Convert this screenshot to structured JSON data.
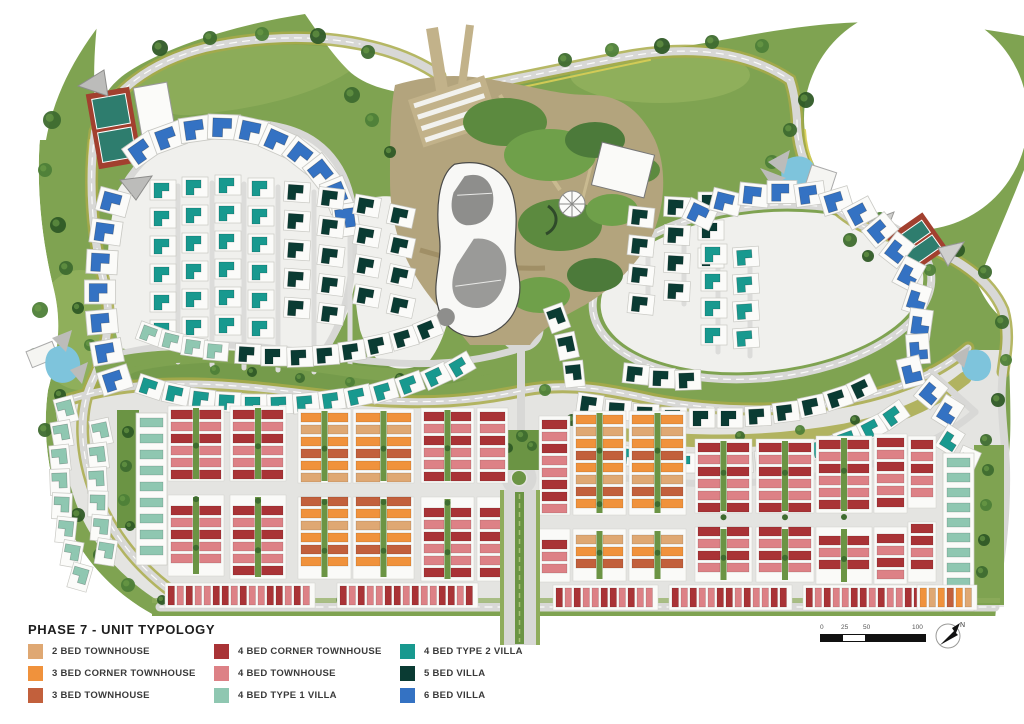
{
  "title": "PHASE 7 - UNIT TYPOLOGY",
  "colors": {
    "tan2": "#DFA873",
    "or3c": "#F0923C",
    "terra3": "#C2603C",
    "red4c": "#A93336",
    "pink4": "#DD8186",
    "mint4": "#8FC7B1",
    "teal4": "#18998F",
    "dark5": "#0A3B33",
    "blue6": "#3472C3"
  },
  "legend": {
    "columns": [
      [
        {
          "label": "2 BED TOWNHOUSE",
          "key": "tan2"
        },
        {
          "label": "3 BED CORNER TOWNHOUSE",
          "key": "or3c"
        },
        {
          "label": "3 BED TOWNHOUSE",
          "key": "terra3"
        }
      ],
      [
        {
          "label": "4 BED CORNER TOWNHOUSE",
          "key": "red4c"
        },
        {
          "label": "4 BED  TOWNHOUSE",
          "key": "pink4"
        },
        {
          "label": "4 BED  TYPE 1 VILLA",
          "key": "mint4"
        }
      ],
      [
        {
          "label": "4 BED  TYPE 2 VILLA",
          "key": "teal4"
        },
        {
          "label": "5 BED VILLA",
          "key": "dark5"
        },
        {
          "label": "6 BED VILLA",
          "key": "blue6"
        }
      ]
    ]
  },
  "scalebar": {
    "labels": [
      "0",
      "25",
      "50",
      "100"
    ]
  },
  "north": {
    "label": "N"
  },
  "map": {
    "unit_patterns": {
      "red": [
        "red4c",
        "pink4",
        "red4c",
        "pink4",
        "pink4",
        "red4c"
      ],
      "orange": [
        "or3c",
        "tan2",
        "or3c",
        "terra3",
        "or3c",
        "tan2",
        "terra3"
      ]
    },
    "villa_clusters": [
      {
        "c": "blue6",
        "s": 1.25,
        "pts": [
          [
            142,
            150,
            -35
          ],
          [
            168,
            137,
            -20
          ],
          [
            196,
            129,
            -8
          ],
          [
            224,
            127,
            2
          ],
          [
            252,
            131,
            12
          ],
          [
            278,
            141,
            24
          ],
          [
            302,
            155,
            38
          ],
          [
            322,
            173,
            52
          ],
          [
            337,
            195,
            68
          ],
          [
            346,
            220,
            82
          ]
        ]
      },
      {
        "c": "blue6",
        "s": 1.2,
        "pts": [
          [
            113,
            202,
            15
          ],
          [
            106,
            232,
            8
          ],
          [
            102,
            262,
            3
          ],
          [
            100,
            292,
            0
          ],
          [
            102,
            322,
            -5
          ],
          [
            107,
            352,
            -10
          ],
          [
            115,
            380,
            -18
          ]
        ]
      },
      {
        "c": "teal4",
        "row": [
          163,
          190,
          0,
          28,
          6,
          0
        ]
      },
      {
        "c": "teal4",
        "row": [
          195,
          187,
          0,
          28,
          6,
          0
        ]
      },
      {
        "c": "teal4",
        "row": [
          228,
          185,
          0,
          28,
          6,
          0
        ]
      },
      {
        "c": "teal4",
        "row": [
          261,
          188,
          0,
          28,
          6,
          0
        ]
      },
      {
        "c": "dark5",
        "row": [
          297,
          192,
          0,
          29,
          5,
          4
        ]
      },
      {
        "c": "dark5",
        "row": [
          331,
          198,
          0,
          29,
          5,
          7
        ]
      },
      {
        "c": "dark5",
        "row": [
          367,
          206,
          0,
          30,
          4,
          10
        ]
      },
      {
        "c": "dark5",
        "row": [
          401,
          216,
          0,
          30,
          4,
          12
        ]
      },
      {
        "c": "mint4",
        "s": 0.95,
        "pts": [
          [
            150,
            334,
            20
          ],
          [
            172,
            341,
            14
          ],
          [
            194,
            347,
            8
          ],
          [
            216,
            351,
            5
          ]
        ]
      },
      {
        "c": "dark5",
        "pts": [
          [
            248,
            354,
            3
          ],
          [
            274,
            356,
            0
          ],
          [
            300,
            357,
            -2
          ],
          [
            326,
            355,
            -4
          ],
          [
            352,
            351,
            -8
          ],
          [
            378,
            345,
            -12
          ],
          [
            404,
            338,
            -16
          ],
          [
            428,
            329,
            -22
          ]
        ]
      },
      {
        "c": "teal4",
        "pts": [
          [
            150,
            387,
            18
          ],
          [
            176,
            394,
            12
          ],
          [
            202,
            399,
            7
          ],
          [
            228,
            402,
            3
          ],
          [
            254,
            404,
            0
          ],
          [
            280,
            404,
            -2
          ],
          [
            306,
            403,
            -5
          ],
          [
            332,
            400,
            -8
          ],
          [
            358,
            396,
            -12
          ],
          [
            384,
            391,
            -16
          ],
          [
            410,
            384,
            -20
          ],
          [
            436,
            376,
            -25
          ],
          [
            460,
            366,
            -30
          ]
        ]
      },
      {
        "c": "dark5",
        "pts": [
          [
            557,
            318,
            70
          ],
          [
            567,
            346,
            78
          ],
          [
            574,
            374,
            84
          ]
        ]
      },
      {
        "c": "dark5",
        "row": [
          641,
          217,
          0,
          29,
          4,
          6
        ]
      },
      {
        "c": "dark5",
        "row": [
          677,
          207,
          0,
          28,
          4,
          3
        ]
      },
      {
        "c": "dark5",
        "row": [
          711,
          202,
          0,
          28,
          3,
          0
        ]
      },
      {
        "c": "teal4",
        "row": [
          714,
          254,
          0,
          27,
          4,
          0
        ]
      },
      {
        "c": "teal4",
        "row": [
          746,
          257,
          0,
          27,
          4,
          -4
        ]
      },
      {
        "c": "dark5",
        "pts": [
          [
            636,
            374,
            6
          ],
          [
            662,
            378,
            2
          ],
          [
            688,
            380,
            -2
          ]
        ]
      },
      {
        "c": "blue6",
        "s": 1.15,
        "pts": [
          [
            700,
            214,
            25
          ],
          [
            726,
            202,
            14
          ],
          [
            754,
            195,
            6
          ],
          [
            782,
            192,
            0
          ],
          [
            810,
            194,
            -8
          ],
          [
            836,
            201,
            -17
          ],
          [
            860,
            213,
            -28
          ],
          [
            880,
            230,
            -40
          ]
        ]
      },
      {
        "c": "blue6",
        "s": 1.15,
        "pts": [
          [
            897,
            250,
            -52
          ],
          [
            909,
            274,
            -62
          ],
          [
            917,
            299,
            -72
          ],
          [
            920,
            324,
            -82
          ],
          [
            918,
            349,
            -94
          ],
          [
            911,
            372,
            -104
          ]
        ]
      },
      {
        "c": "blue6",
        "s": 1.1,
        "pts": [
          [
            931,
            392,
            -50
          ],
          [
            948,
            412,
            -58
          ]
        ]
      },
      {
        "c": "teal4",
        "pts": [
          [
            950,
            440,
            -58
          ],
          [
            967,
            461,
            -66
          ]
        ]
      },
      {
        "c": "dark5",
        "pts": [
          [
            590,
            404,
            8
          ],
          [
            618,
            410,
            4
          ],
          [
            646,
            414,
            2
          ],
          [
            674,
            417,
            0
          ],
          [
            702,
            418,
            0
          ],
          [
            730,
            418,
            0
          ],
          [
            758,
            416,
            -3
          ],
          [
            786,
            412,
            -7
          ],
          [
            812,
            406,
            -12
          ],
          [
            838,
            398,
            -18
          ],
          [
            862,
            388,
            -25
          ]
        ]
      },
      {
        "c": "teal4",
        "pts": [
          [
            600,
            450,
            10
          ],
          [
            628,
            456,
            5
          ],
          [
            656,
            460,
            2
          ],
          [
            684,
            463,
            0
          ],
          [
            712,
            464,
            0
          ],
          [
            740,
            463,
            -2
          ],
          [
            768,
            460,
            -5
          ],
          [
            796,
            455,
            -9
          ],
          [
            822,
            448,
            -14
          ],
          [
            848,
            439,
            -20
          ],
          [
            872,
            428,
            -27
          ],
          [
            894,
            415,
            -35
          ]
        ]
      },
      {
        "c": "mint4",
        "pts": [
          [
            66,
            410,
            75
          ],
          [
            62,
            434,
            80
          ],
          [
            60,
            458,
            84
          ],
          [
            60,
            482,
            88
          ],
          [
            62,
            506,
            92
          ],
          [
            66,
            530,
            96
          ],
          [
            72,
            554,
            100
          ],
          [
            80,
            577,
            106
          ]
        ]
      },
      {
        "c": "mint4",
        "pts": [
          [
            101,
            432,
            78
          ],
          [
            98,
            456,
            83
          ],
          [
            97,
            480,
            87
          ],
          [
            98,
            504,
            91
          ],
          [
            101,
            528,
            95
          ],
          [
            106,
            552,
            99
          ]
        ]
      }
    ],
    "bar_columns": [
      {
        "c": "mint4",
        "x": 140,
        "y": 418,
        "n": 9,
        "uw": 23,
        "uh": 9,
        "pitch": 16
      },
      {
        "c": "mint4",
        "x": 947,
        "y": 458,
        "n": 10,
        "uw": 23,
        "uh": 9,
        "pitch": 15
      }
    ],
    "townhouse_blocks": [
      {
        "x": 170,
        "y": 410,
        "w": 52,
        "h": 162,
        "color": "red",
        "road_y": 488
      },
      {
        "x": 232,
        "y": 410,
        "w": 52,
        "h": 165,
        "color": "red",
        "road_y": 488
      },
      {
        "x": 300,
        "y": 413,
        "w": 49,
        "h": 162,
        "color": "orange",
        "road_y": 490
      },
      {
        "x": 355,
        "y": 413,
        "w": 57,
        "h": 162,
        "color": "orange",
        "road_y": 490
      },
      {
        "x": 423,
        "y": 412,
        "w": 49,
        "h": 165,
        "color": "red",
        "road_y": 490
      },
      {
        "x": 479,
        "y": 412,
        "w": 27,
        "h": 165,
        "color": "red",
        "road_y": 490,
        "single": true
      },
      {
        "x": 541,
        "y": 420,
        "w": 27,
        "h": 158,
        "color": "red",
        "road_y": 522,
        "single": true
      },
      {
        "x": 575,
        "y": 415,
        "w": 49,
        "h": 162,
        "color": "orange",
        "road_y": 522
      },
      {
        "x": 631,
        "y": 415,
        "w": 53,
        "h": 162,
        "color": "orange",
        "road_y": 522
      },
      {
        "x": 697,
        "y": 443,
        "w": 53,
        "h": 135,
        "color": "red",
        "road_y": 520
      },
      {
        "x": 758,
        "y": 443,
        "w": 54,
        "h": 135,
        "color": "red",
        "road_y": 520
      },
      {
        "x": 818,
        "y": 440,
        "w": 52,
        "h": 140,
        "color": "red",
        "road_y": 520
      },
      {
        "x": 876,
        "y": 438,
        "w": 29,
        "h": 142,
        "color": "red",
        "road_y": 520,
        "single": true
      },
      {
        "x": 910,
        "y": 440,
        "w": 24,
        "h": 138,
        "color": "red",
        "road_y": 515,
        "single": true
      }
    ],
    "strips": [
      {
        "x": 168,
        "y": 586,
        "n": 16,
        "color": "red"
      },
      {
        "x": 340,
        "y": 586,
        "n": 15,
        "color": "red"
      },
      {
        "x": 556,
        "y": 588,
        "n": 11,
        "color": "red"
      },
      {
        "x": 672,
        "y": 588,
        "n": 13,
        "color": "red"
      },
      {
        "x": 806,
        "y": 588,
        "n": 14,
        "color": "red"
      },
      {
        "x": 920,
        "y": 588,
        "n": 6,
        "color": "orange"
      }
    ]
  }
}
